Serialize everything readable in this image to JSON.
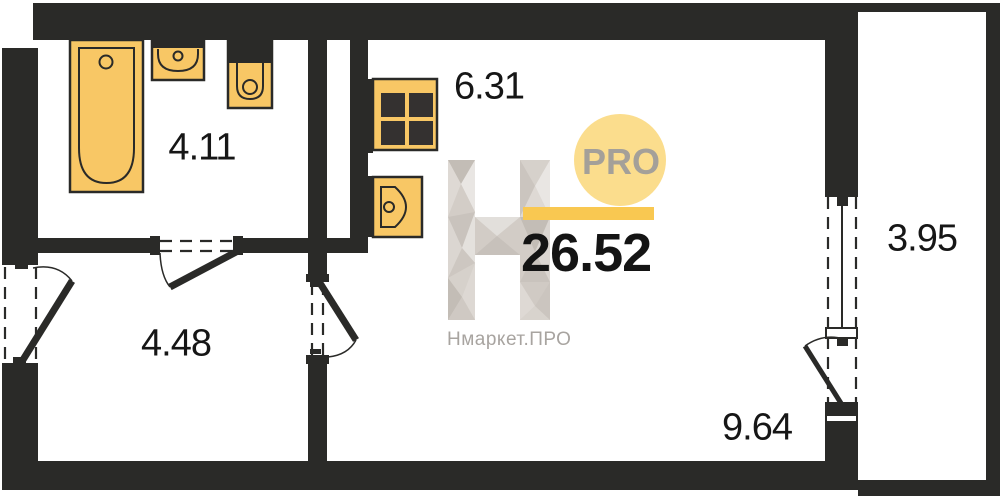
{
  "plan": {
    "total_area": "26.52",
    "rooms": [
      {
        "name": "bathroom",
        "area": "4.11"
      },
      {
        "name": "kitchen",
        "area": "6.31"
      },
      {
        "name": "hallway",
        "area": "4.48"
      },
      {
        "name": "living-room",
        "area": "9.64"
      },
      {
        "name": "balcony",
        "area": "3.95"
      }
    ],
    "fixtures": [
      "bathtub",
      "washbasin",
      "toilet",
      "stove",
      "kitchen-sink"
    ]
  },
  "watermark": {
    "badge": "PRO",
    "site": "Нмаркет.ПРО",
    "total": "26.52"
  },
  "colors": {
    "wall": "#2a2a28",
    "fixture_fill": "#f8c765",
    "burner": "#343130",
    "badge_circle": "#fbdd8d",
    "accent_bar": "#f9c851",
    "logo_grey": "#d2ccc6",
    "watermark_text": "#a8a4a0",
    "label_text": "#161616"
  }
}
